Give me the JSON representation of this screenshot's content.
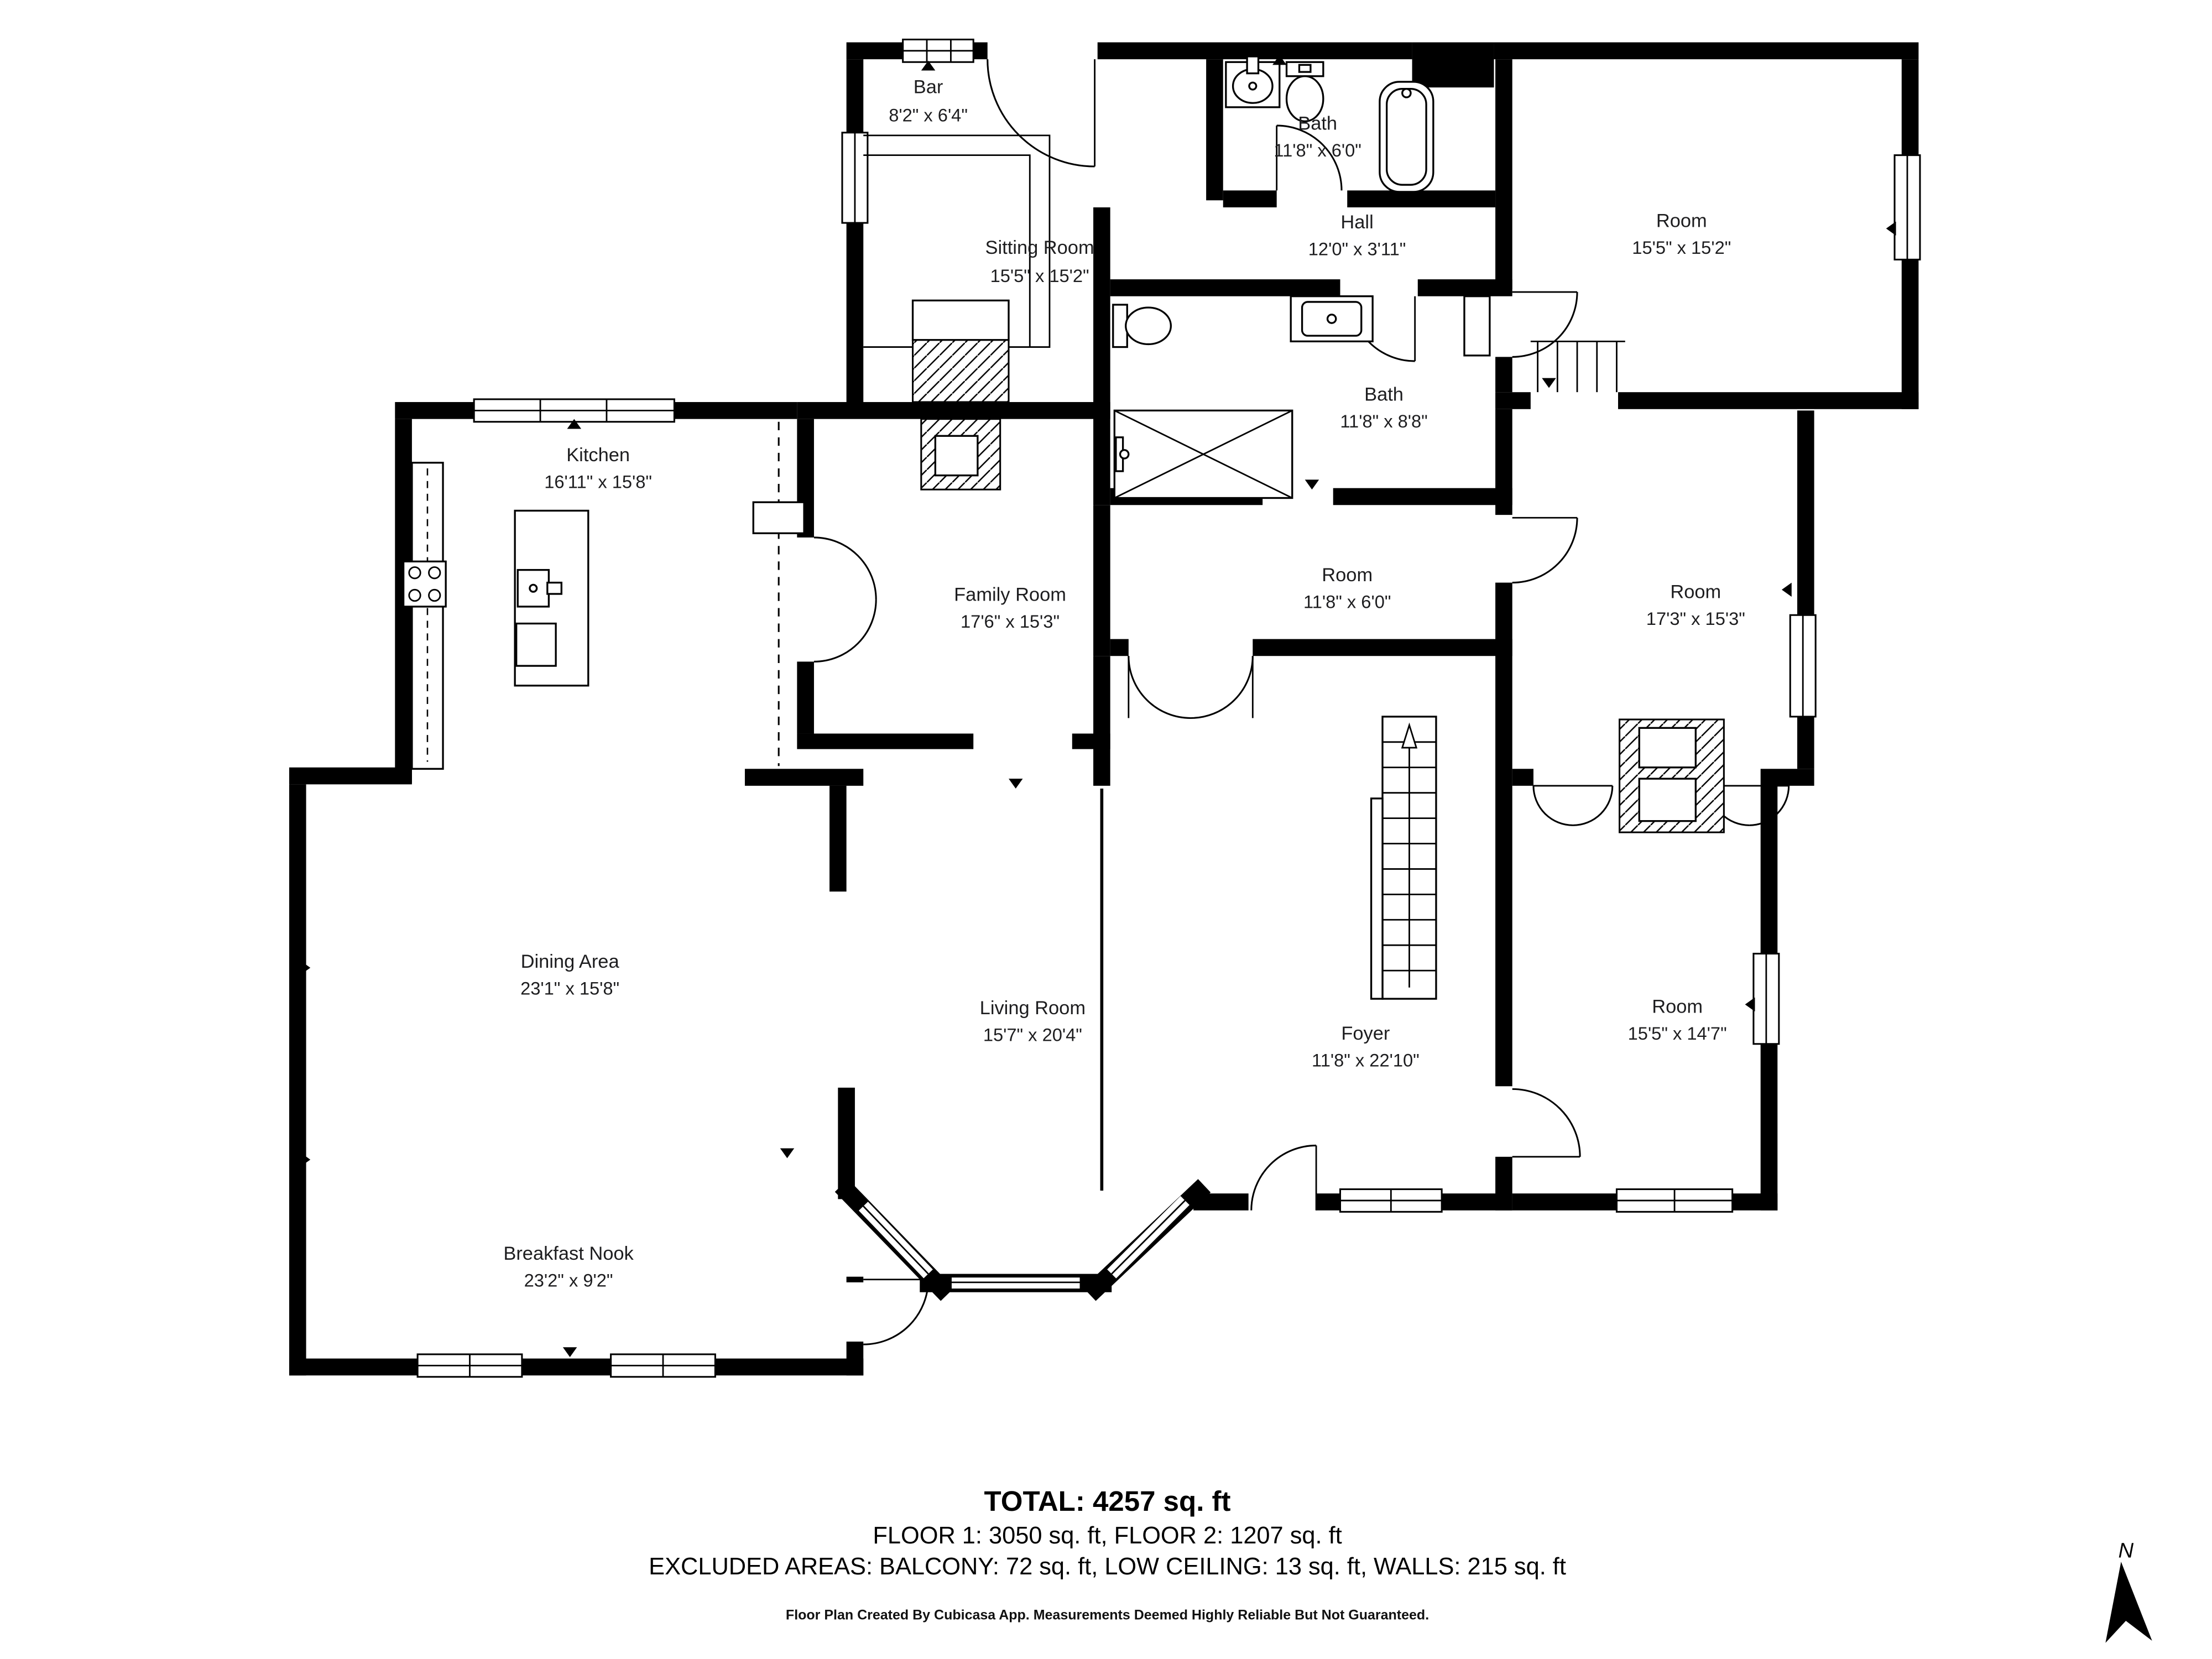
{
  "page": {
    "background": "#ffffff",
    "ink": "#000000"
  },
  "rooms": [
    {
      "id": "bar",
      "name": "Bar",
      "dims": "8'2\" x 6'4\""
    },
    {
      "id": "bath-upper",
      "name": "Bath",
      "dims": "11'8\" x 6'0\""
    },
    {
      "id": "sitting-room",
      "name": "Sitting Room",
      "dims": "15'5\" x 15'2\""
    },
    {
      "id": "hall",
      "name": "Hall",
      "dims": "12'0\" x 3'11\""
    },
    {
      "id": "room-top-right",
      "name": "Room",
      "dims": "15'5\" x 15'2\""
    },
    {
      "id": "bath-middle",
      "name": "Bath",
      "dims": "11'8\" x 8'8\""
    },
    {
      "id": "kitchen",
      "name": "Kitchen",
      "dims": "16'11\" x 15'8\""
    },
    {
      "id": "family-room",
      "name": "Family Room",
      "dims": "17'6\" x 15'3\""
    },
    {
      "id": "room-small",
      "name": "Room",
      "dims": "11'8\" x 6'0\""
    },
    {
      "id": "room-mid-right",
      "name": "Room",
      "dims": "17'3\" x 15'3\""
    },
    {
      "id": "dining-area",
      "name": "Dining Area",
      "dims": "23'1\" x 15'8\""
    },
    {
      "id": "living-room",
      "name": "Living Room",
      "dims": "15'7\" x 20'4\""
    },
    {
      "id": "foyer",
      "name": "Foyer",
      "dims": "11'8\" x 22'10\""
    },
    {
      "id": "room-bottom-right",
      "name": "Room",
      "dims": "15'5\" x 14'7\""
    },
    {
      "id": "breakfast-nook",
      "name": "Breakfast Nook",
      "dims": "23'2\" x 9'2\""
    }
  ],
  "summary": {
    "total": "TOTAL: 4257 sq. ft",
    "floors": "FLOOR 1: 3050 sq. ft, FLOOR 2: 1207 sq. ft",
    "excluded": "EXCLUDED AREAS: BALCONY: 72 sq. ft, LOW CEILING: 13 sq. ft, WALLS: 215 sq. ft"
  },
  "footer": "Floor Plan Created By Cubicasa App. Measurements Deemed Highly Reliable But Not Guaranteed.",
  "compass": {
    "label": "N"
  },
  "icons": {
    "compass-north-icon": "tilted navigation arrow",
    "stairs-icon": "treads with up arrow",
    "bathtub-icon": "rounded rectangle tub",
    "toilet-icon": "tank and bowl",
    "sink-icon": "oval basin in vanity",
    "shower-icon": "crossed box",
    "stove-icon": "four burner cooktop",
    "kitchen-island-icon": "island with sink",
    "fireplace-icon": "hatched masonry box",
    "window-icon": "double-line opening",
    "door-icon": "quarter-circle swing"
  }
}
